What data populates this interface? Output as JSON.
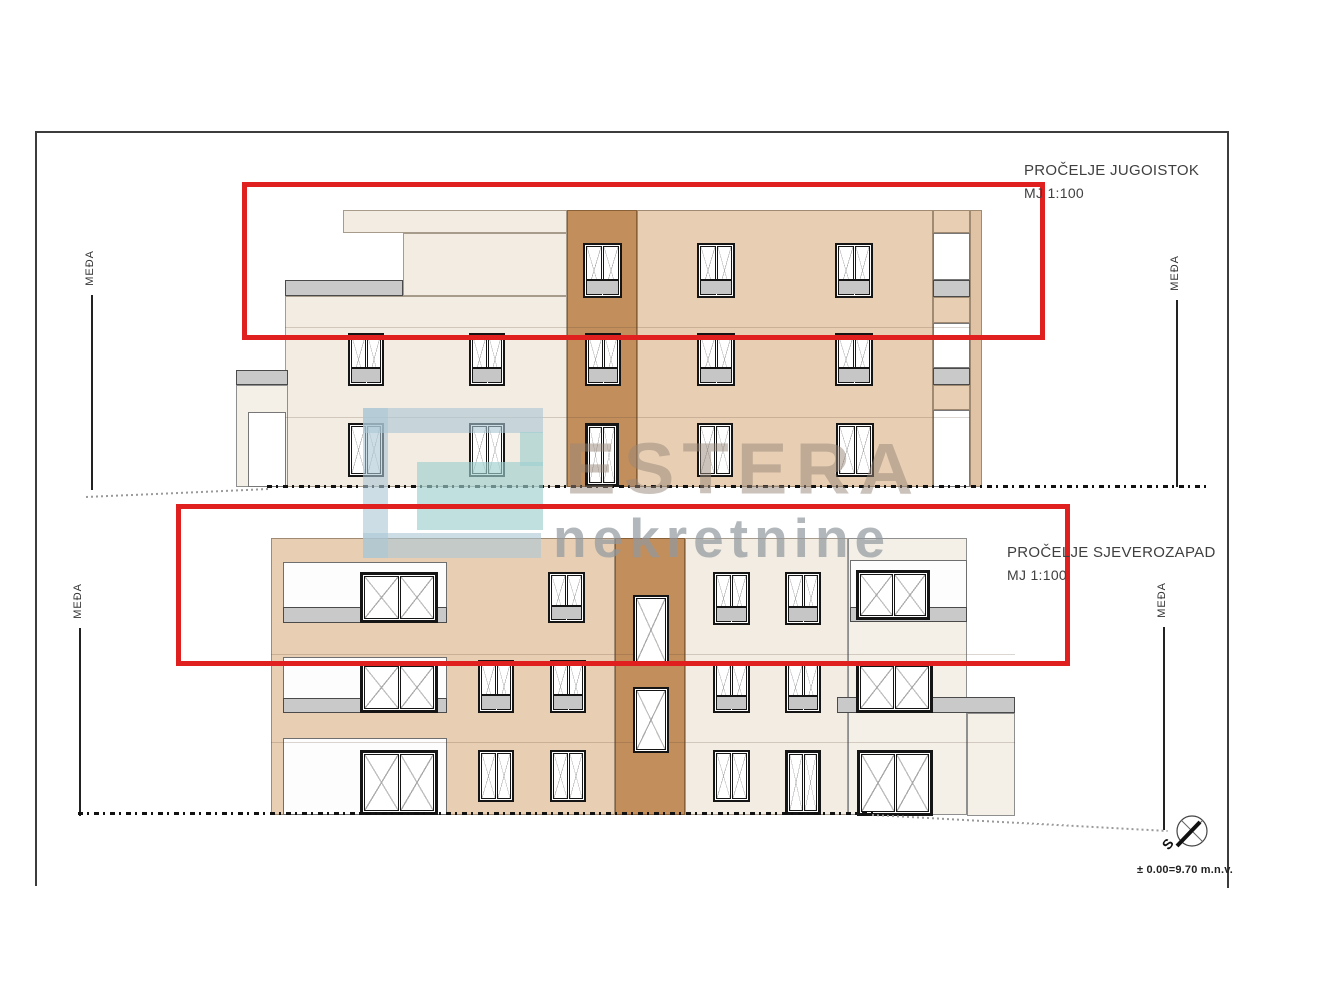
{
  "labels": {
    "meda": "MEĐA",
    "level_note": "± 0.00=9.70 m.n.v.",
    "compass_s": "S"
  },
  "elevations": [
    {
      "title": "PROČELJE JUGOISTOK",
      "scale": "MJ 1:100"
    },
    {
      "title": "PROČELJE SJEVEROZAPAD",
      "scale": "MJ 1:100"
    }
  ],
  "watermark": {
    "brand": "ESTERA",
    "subtitle": "nekretnine"
  },
  "colors": {
    "highlight_red": "#e01f1f",
    "wall_cream": "#f2ece2",
    "wall_tan": "#e8cfb4",
    "wall_brown": "#c28e5c",
    "slab_gray": "#c9c9c9"
  }
}
